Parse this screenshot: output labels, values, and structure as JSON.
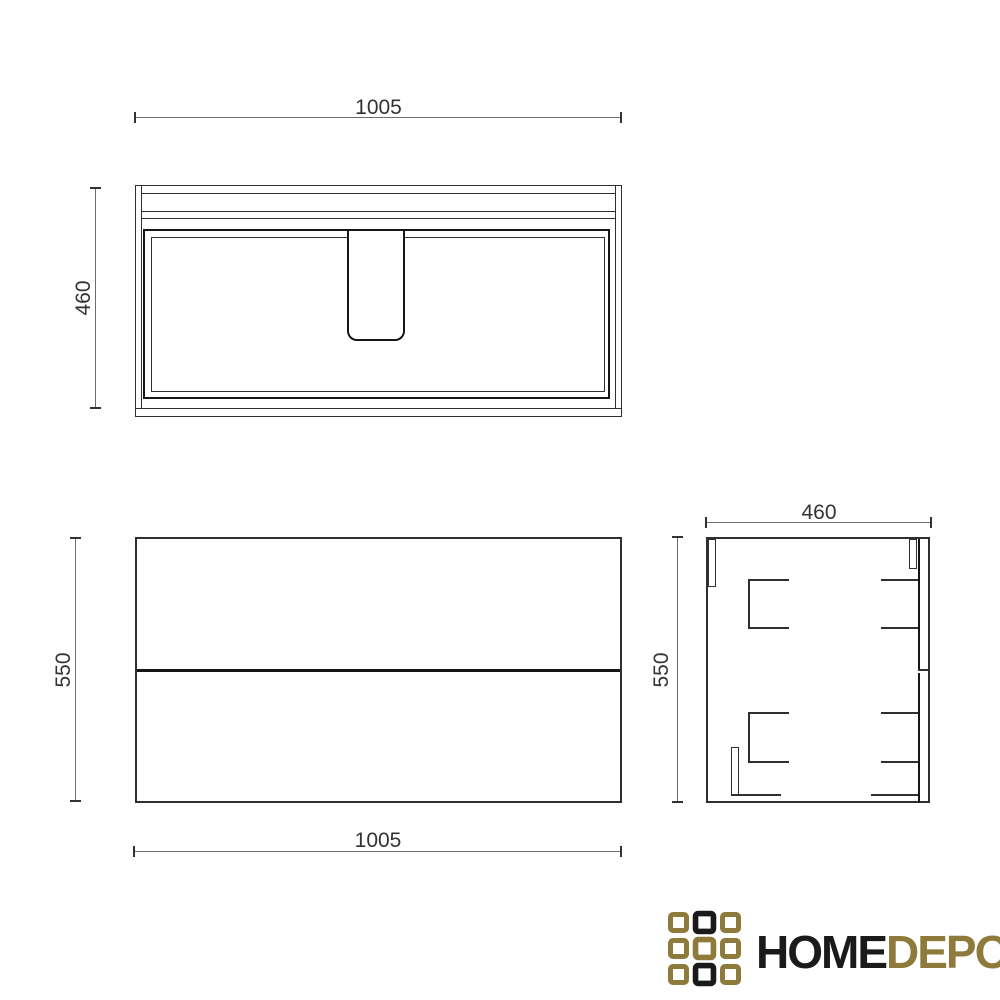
{
  "views": {
    "top": {
      "label_width": "1005",
      "label_depth": "460"
    },
    "front": {
      "label_height": "550",
      "label_width": "1005"
    },
    "side": {
      "label_depth": "460",
      "label_height": "550"
    }
  },
  "logo": {
    "word_primary": "HOME",
    "word_secondary": "DEPO",
    "gold": "#8E7B3C",
    "dark": "#1A1A1A",
    "grid": [
      [
        "gold",
        "dark",
        "gold"
      ],
      [
        "gold",
        "gold",
        "gold"
      ],
      [
        "gold",
        "dark",
        "gold"
      ]
    ]
  },
  "colors": {
    "background": "#FFFFFF",
    "line": "#2F2F2F",
    "line_bold": "#161616",
    "dim_line": "#6E6E6E",
    "dim_text": "#333333"
  }
}
